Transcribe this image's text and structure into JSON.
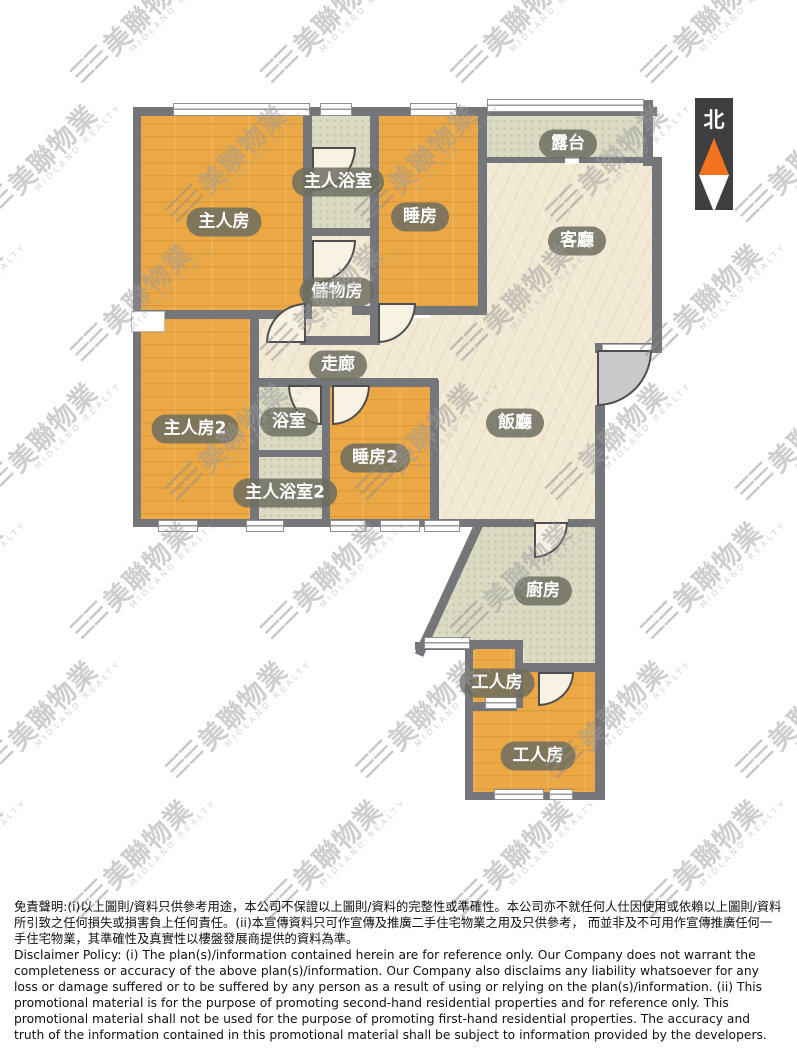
{
  "compass": {
    "north_label": "北"
  },
  "rooms": {
    "master_bedroom": "主人房",
    "master_bathroom": "主人浴室",
    "bedroom": "睡房",
    "balcony": "露台",
    "living_room": "客廳",
    "storage_room": "儲物房",
    "corridor": "走廊",
    "master_bedroom_2": "主人房2",
    "bathroom": "浴室",
    "bedroom_2": "睡房2",
    "master_bathroom_2": "主人浴室2",
    "dining_room": "飯廳",
    "kitchen": "廚房",
    "servant_room_small": "工人房",
    "servant_room_large": "工人房"
  },
  "watermark": {
    "logo_glyph": "☰☰",
    "name_zh": "美聯物業",
    "name_en": "MIDLAND REALTY"
  },
  "disclaimer": {
    "zh": "免責聲明:(i)以上圖則/資料只供參考用途，本公司不保證以上圖則/資料的完整性或準確性。本公司亦不就任何人仕因使用或依賴以上圖則/資料所引致之任何損失或損害負上任何責任。(ii)本宣傳資料只可作宣傳及推廣二手住宅物業之用及只供參考， 而並非及不可用作宣傳推廣任何一手住宅物業，其準確性及真實性以樓盤發展商提供的資料為準。",
    "en": "Disclaimer Policy: (i) The plan(s)/information contained herein are for reference only. Our Company does not warrant the completeness or accuracy of the above plan(s)/information. Our Company also disclaims any liability whatsoever for any loss or damage suffered or to be suffered by any person as a result of using or relying on the plan(s)/information. (ii) This promotional material is for the purpose of promoting second-hand residential properties and for reference only. This promotional material shall not be used for the purpose of promoting first-hand residential properties. The accuracy and truth of the information contained in this promotional material shall be subject to information provided by the developers."
  },
  "colors": {
    "bedroom_floor": "#eba844",
    "living_floor": "#f2e9d4",
    "wet_area_floor": "#dbdbc4",
    "wall": "#75767a",
    "label_pill": "#6d6d5f",
    "north_arrow_orange": "#f4731f",
    "north_box": "#3f3f41"
  }
}
